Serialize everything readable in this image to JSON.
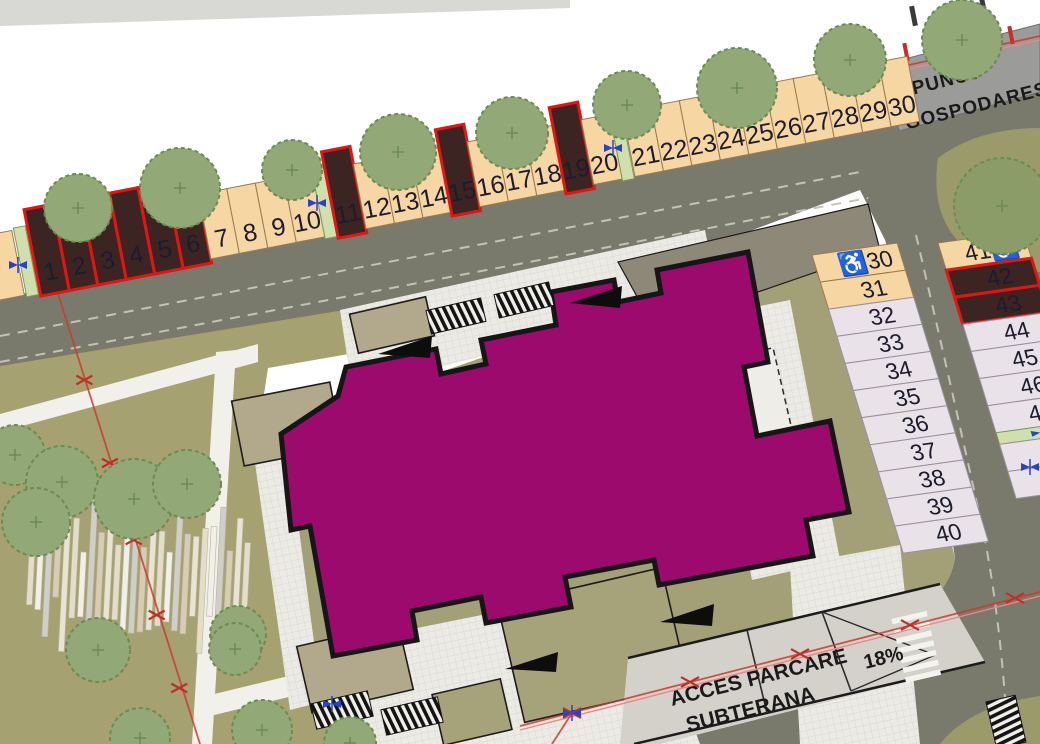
{
  "plan": {
    "utility_label": {
      "line1": "PUNCT",
      "line2": "GOSPODARESC"
    },
    "ramp_label": {
      "line1": "ACCES PARCARE",
      "line2": "SUBTERANA",
      "slope": "18%"
    },
    "accessible_icon": "♿"
  },
  "parking": {
    "top_row": [
      {
        "n": "1",
        "type": "reserved"
      },
      {
        "n": "2",
        "type": "reserved"
      },
      {
        "n": "3",
        "type": "reserved"
      },
      {
        "n": "4",
        "type": "reserved"
      },
      {
        "n": "5",
        "type": "reserved"
      },
      {
        "n": "6",
        "type": "reserved"
      },
      {
        "n": "7",
        "type": "standard"
      },
      {
        "n": "8",
        "type": "standard"
      },
      {
        "n": "9",
        "type": "standard"
      },
      {
        "n": "10",
        "type": "standard"
      },
      {
        "n": "11",
        "type": "reserved"
      },
      {
        "n": "12",
        "type": "standard"
      },
      {
        "n": "13",
        "type": "standard"
      },
      {
        "n": "14",
        "type": "standard"
      },
      {
        "n": "15",
        "type": "reserved"
      },
      {
        "n": "16",
        "type": "standard"
      },
      {
        "n": "17",
        "type": "standard"
      },
      {
        "n": "18",
        "type": "standard"
      },
      {
        "n": "19",
        "type": "reserved"
      },
      {
        "n": "20",
        "type": "standard"
      },
      {
        "n": "21",
        "type": "standard"
      },
      {
        "n": "22",
        "type": "standard"
      },
      {
        "n": "23",
        "type": "standard"
      },
      {
        "n": "24",
        "type": "standard"
      },
      {
        "n": "25",
        "type": "standard"
      },
      {
        "n": "26",
        "type": "standard"
      },
      {
        "n": "27",
        "type": "standard"
      },
      {
        "n": "28",
        "type": "standard"
      },
      {
        "n": "29",
        "type": "standard"
      },
      {
        "n": "30",
        "type": "standard"
      }
    ],
    "right_column_a": [
      {
        "n": "30",
        "type": "accessible",
        "icon_side": "left"
      },
      {
        "n": "31",
        "type": "standard"
      },
      {
        "n": "32",
        "type": "standard_alt"
      },
      {
        "n": "33",
        "type": "standard_alt"
      },
      {
        "n": "34",
        "type": "standard_alt"
      },
      {
        "n": "35",
        "type": "standard_alt"
      },
      {
        "n": "36",
        "type": "standard_alt"
      },
      {
        "n": "37",
        "type": "standard_alt"
      },
      {
        "n": "38",
        "type": "standard_alt"
      },
      {
        "n": "39",
        "type": "standard_alt"
      },
      {
        "n": "40",
        "type": "standard_alt"
      }
    ],
    "right_column_b": [
      {
        "n": "41",
        "type": "accessible",
        "icon_side": "right"
      },
      {
        "n": "42",
        "type": "reserved"
      },
      {
        "n": "43",
        "type": "reserved"
      },
      {
        "n": "44",
        "type": "standard_alt"
      },
      {
        "n": "45",
        "type": "standard_alt"
      },
      {
        "n": "46",
        "type": "standard_alt"
      },
      {
        "n": "47",
        "type": "standard_alt"
      },
      {
        "type": "separator"
      },
      {
        "n": "",
        "type": "standard_alt"
      },
      {
        "n": "",
        "type": "standard_alt"
      }
    ],
    "colors": {
      "standard": "#f6d6a2",
      "standard_alt": "#eae2e9",
      "accessible": "#f6d6a2",
      "reserved_fill": "#3c2422",
      "reserved_border": "#e41511",
      "separator": "#cfe0ae",
      "cell_border": "#9a7a52",
      "alt_border": "#9a8f9c",
      "number_color": "#1c1c2e"
    }
  },
  "map_colors": {
    "building": "#9c0a6e",
    "building_outline": "#161616",
    "road": "#7a7a6c",
    "grass": "#a5a171",
    "courtyard": "#a3a077",
    "tree": "#93a877",
    "tree_dark": "#8b9c68",
    "paving": "#ebeae4",
    "canopy": "#b2a88b",
    "utility_box": "#9b9b99",
    "ramp_surface": "#d3d1c9",
    "boundary_red": "#cc3a30",
    "survey_blue": "#2743c8"
  }
}
